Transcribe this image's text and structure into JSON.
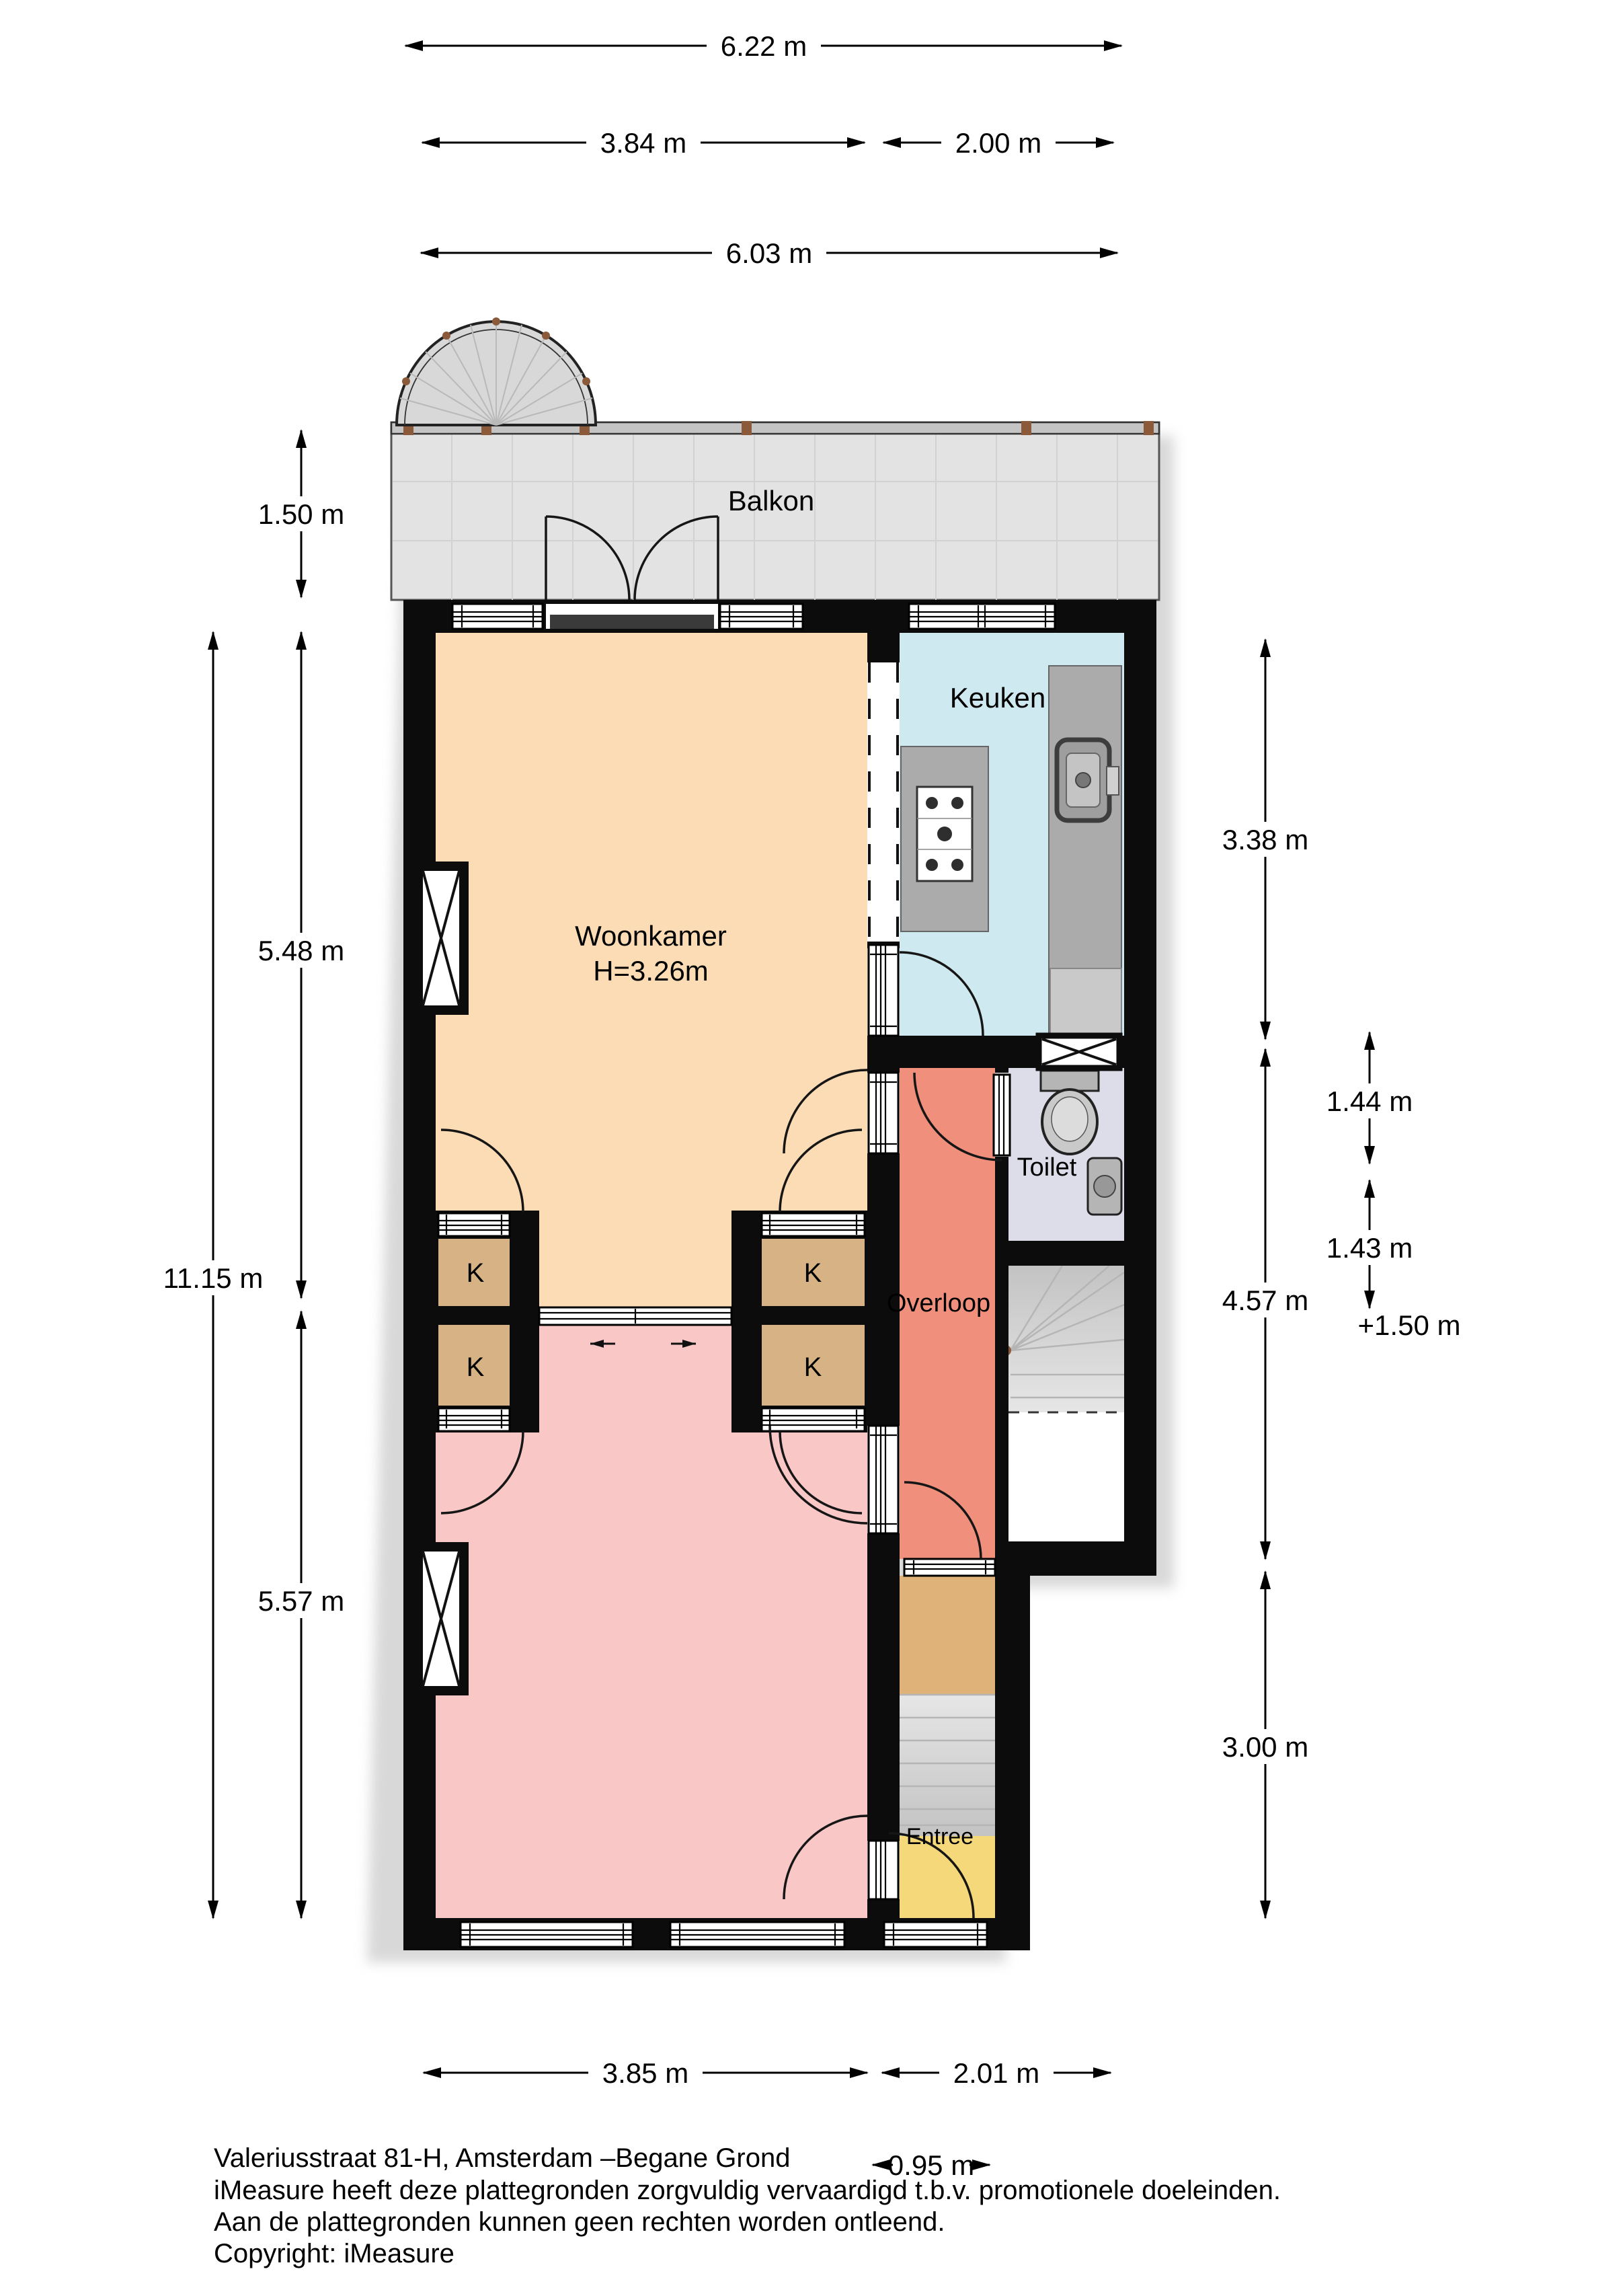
{
  "rooms": {
    "balkon": {
      "label": "Balkon",
      "color": "#e3e3e3"
    },
    "woonkamer": {
      "label": "Woonkamer",
      "ceiling_height": "H=3.26m",
      "color": "#fcdcb5"
    },
    "keuken": {
      "label": "Keuken",
      "color": "#cfe9f0"
    },
    "toilet": {
      "label": "Toilet",
      "color": "#dcdde8"
    },
    "overloop": {
      "label": "Overloop",
      "color": "#ef8f7c"
    },
    "entree": {
      "label": "Entree",
      "color": "#f5d87a"
    },
    "front_room": {
      "color": "#f8c7c6"
    },
    "hall_section": {
      "color": "#dfb279"
    },
    "closet": {
      "label": "K",
      "color": "#d6b285"
    }
  },
  "dimensions": {
    "top": [
      {
        "label": "6.22 m"
      },
      {
        "label": "3.84 m"
      },
      {
        "label": "2.00 m"
      },
      {
        "label": "6.03 m"
      }
    ],
    "left": [
      {
        "label": "1.50 m"
      },
      {
        "label": "5.48 m"
      },
      {
        "label": "11.15 m"
      },
      {
        "label": "5.57 m"
      }
    ],
    "right": [
      {
        "label": "3.38 m"
      },
      {
        "label": "1.44 m"
      },
      {
        "label": "4.57 m"
      },
      {
        "label": "1.43 m"
      },
      {
        "label": "+1.50 m"
      },
      {
        "label": "3.00 m"
      }
    ],
    "bottom": [
      {
        "label": "3.85 m"
      },
      {
        "label": "2.01 m"
      },
      {
        "label": "0.95 m"
      }
    ]
  },
  "footer": {
    "line1": "Valeriusstraat 81-H, Amsterdam –Begane Grond",
    "line2": "iMeasure heeft deze plattegronden zorgvuldig vervaardigd t.b.v. promotionele doeleinden.",
    "line3": "Aan de plattegronden kunnen geen rechten worden ontleend.",
    "line4": "Copyright: iMeasure"
  },
  "colors": {
    "wall": "#0c0c0c",
    "stairs": "#d9d9d9",
    "counter": "#ababab",
    "void": "#ffffff",
    "railing": "#c4c4c4",
    "wood_post": "#8a5a3b"
  }
}
